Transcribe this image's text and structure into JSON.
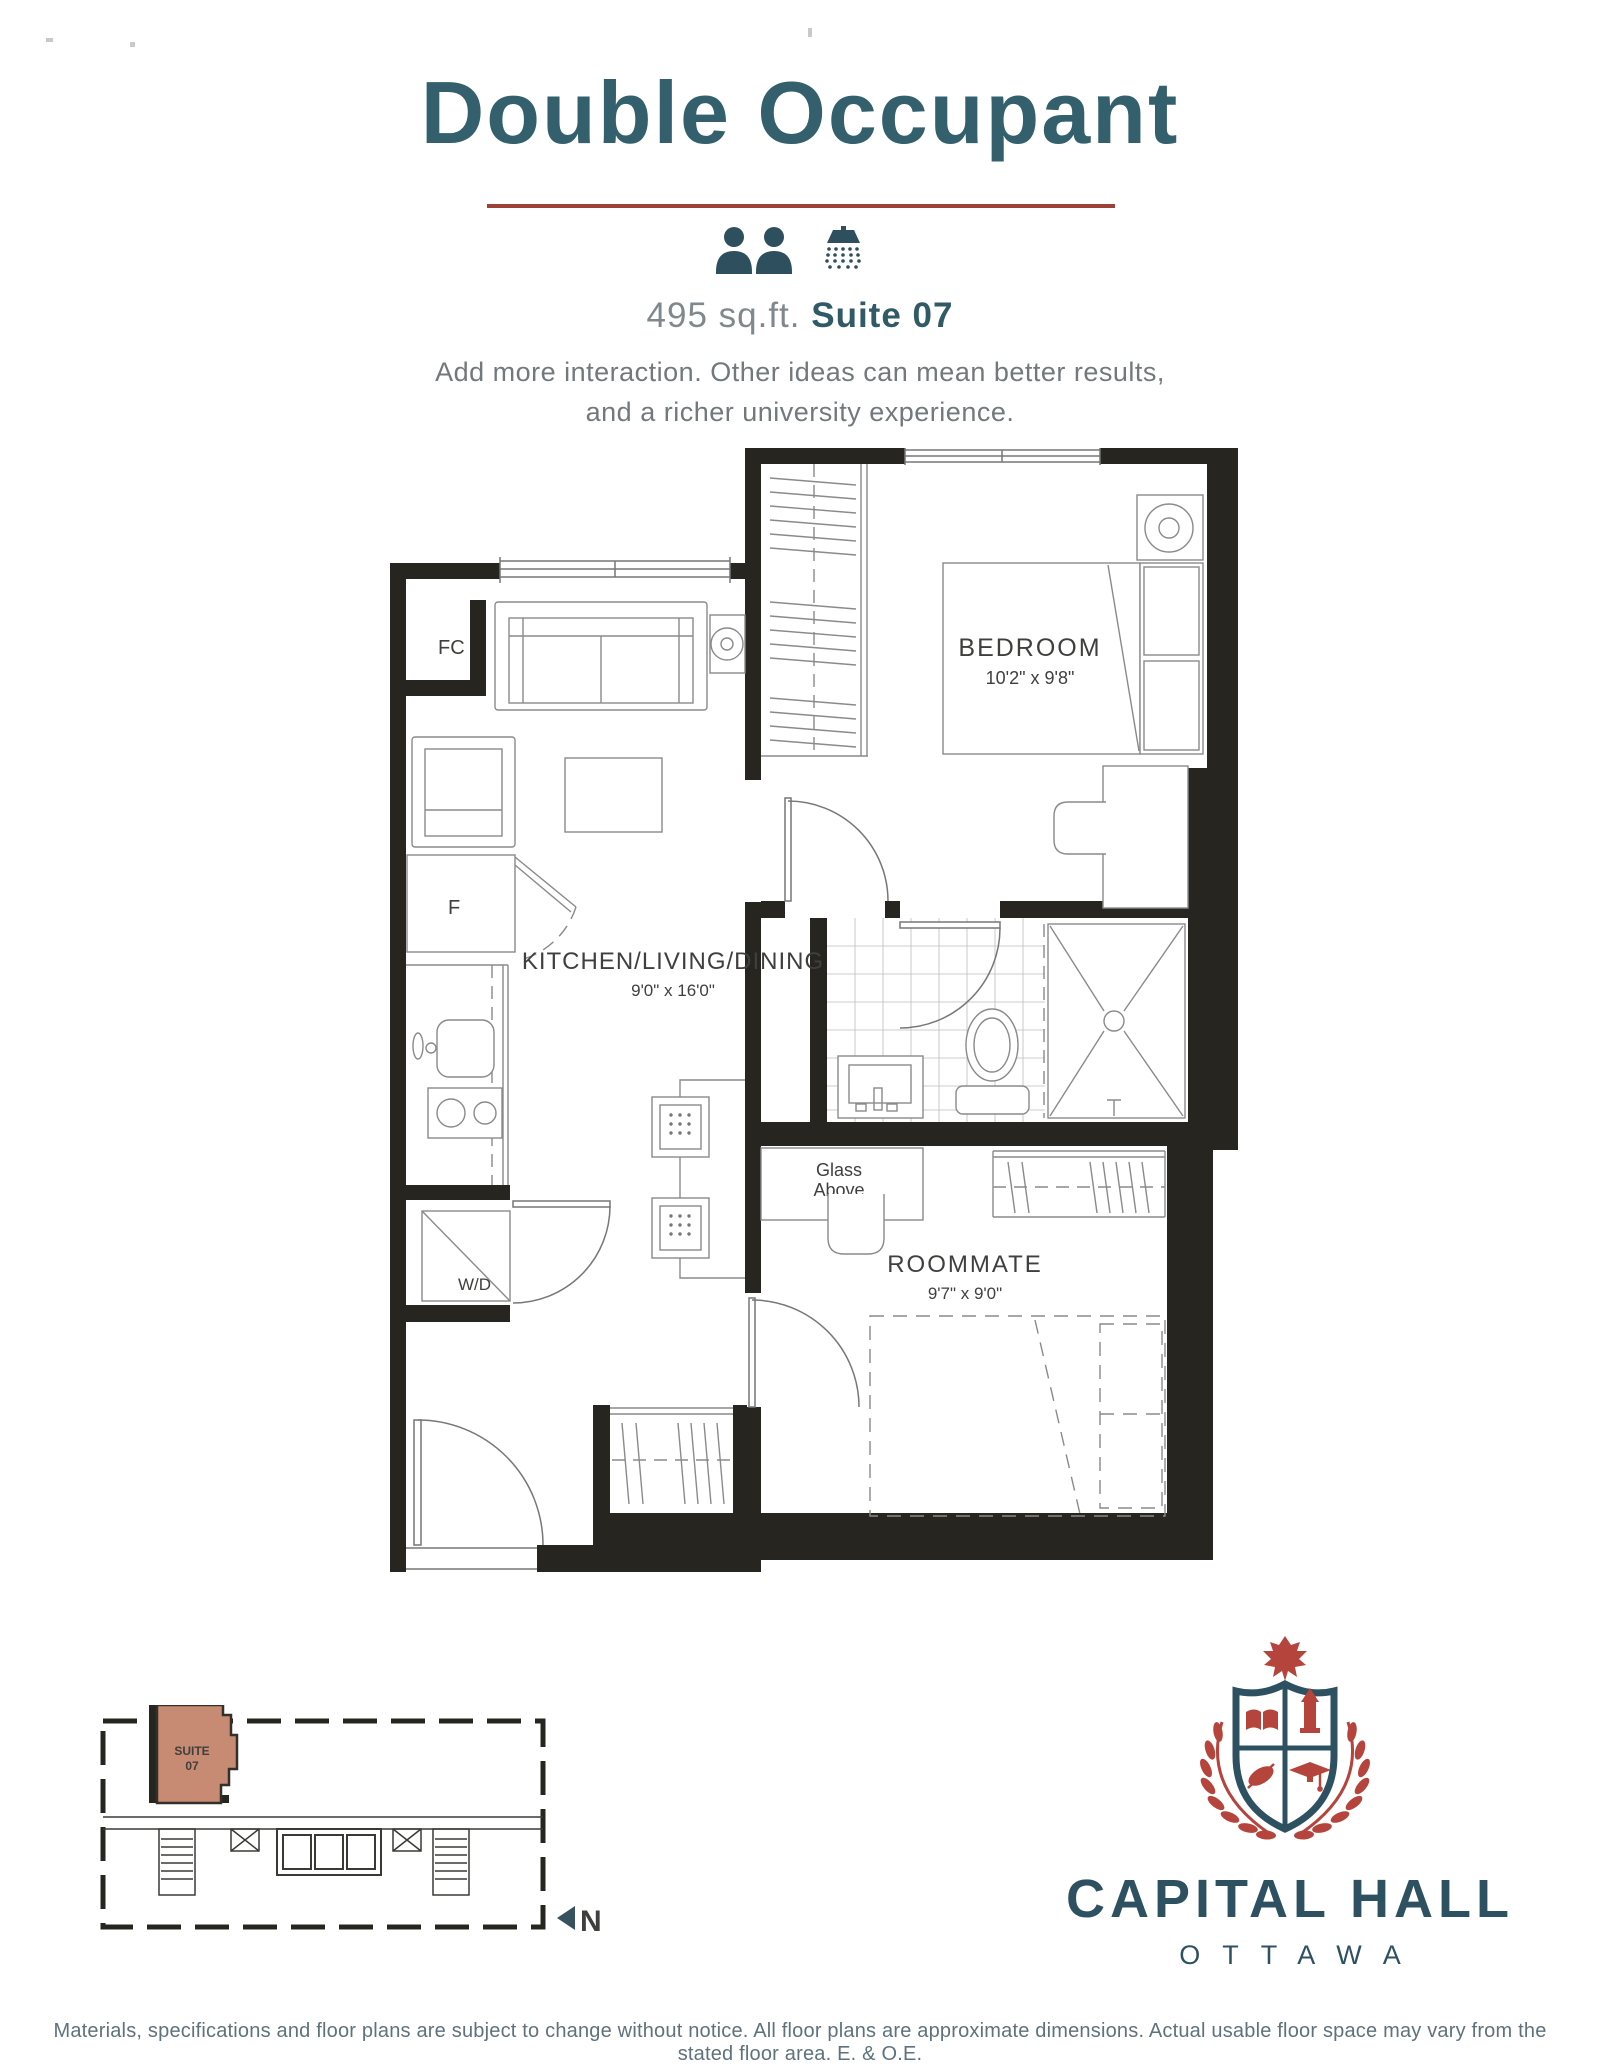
{
  "header": {
    "title": "Double Occupant",
    "area": "495 sq.ft. ",
    "suite": "Suite 07",
    "description_line1": "Add more interaction. Other ideas can mean better results,",
    "description_line2": "and a richer university experience.",
    "icons": [
      "person-icon",
      "person-icon",
      "shower-icon"
    ]
  },
  "floorplan": {
    "rooms": [
      {
        "name": "BEDROOM",
        "dims": "10'2\" x 9'8\""
      },
      {
        "name": "KITCHEN/LIVING/DINING",
        "dims": "9'0\" x 16'0\""
      },
      {
        "name": "ROOMMATE",
        "dims": "9'7\" x 9'0\""
      }
    ],
    "labels": {
      "fc": "FC",
      "f": "F",
      "wd": "W/D",
      "glass1": "Glass",
      "glass2": "Above"
    }
  },
  "keyplan": {
    "suite1": "SUITE",
    "suite2": "07",
    "north": "N"
  },
  "brand": {
    "name": "CAPITAL HALL",
    "city": "OTTAWA"
  },
  "footer": {
    "text": "Materials, specifications and floor plans are subject to change without notice. All floor plans are approximate dimensions. Actual usable floor space may vary from the stated floor area. E. & O.E."
  },
  "colors": {
    "heading_teal": "#33606c",
    "brick_red": "#9c4136",
    "icon_teal": "#2e4f5d",
    "wall_black": "#26251f",
    "suite_fill": "#c68b72",
    "brand_teal": "#2e5161",
    "crest_red": "#b5453c"
  }
}
